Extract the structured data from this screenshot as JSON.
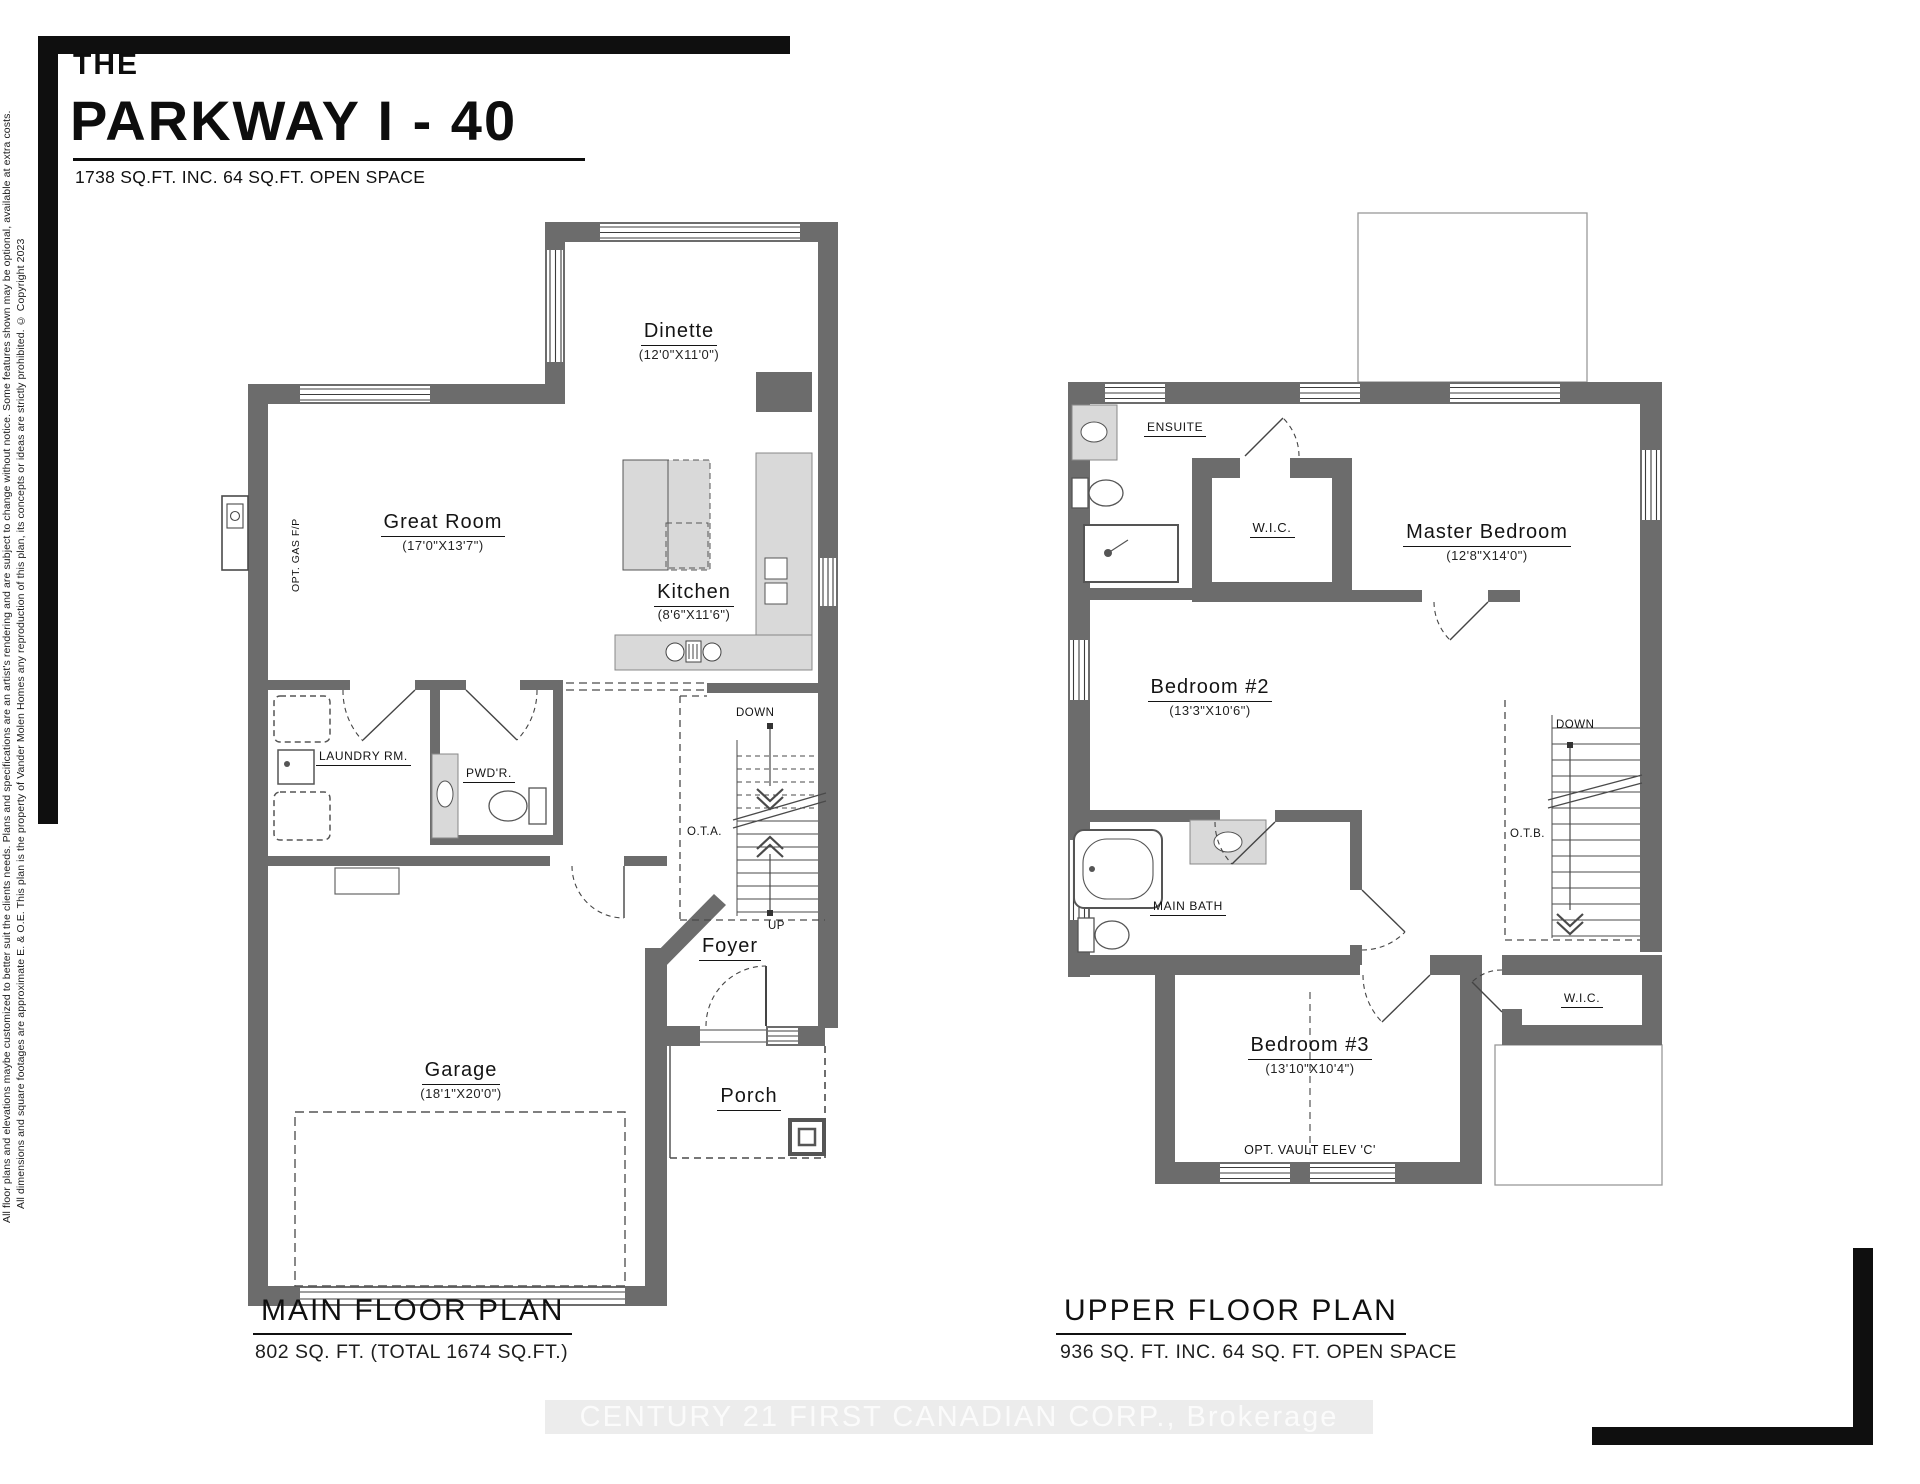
{
  "header": {
    "the": "THE",
    "title": "PARKWAY I - 40",
    "subtitle": "1738 SQ.FT. INC. 64 SQ.FT. OPEN SPACE"
  },
  "side_notes": {
    "line1": "All floor plans and elevations maybe customized to better suit the clients needs. Plans and specifications are an artist's rendering and are subject to change without notice. Some features shown may be optional, available at extra costs.",
    "line2": "All dimensions and square footages are approximate E. & O.E. This plan is the property of Vander Molen Homes any reproduction of this plan, its concepts or ideas are strictly prohibited. © Copyright 2023"
  },
  "watermark": "CENTURY 21 FIRST CANADIAN CORP., Brokerage",
  "main": {
    "caption": "MAIN FLOOR PLAN",
    "caption_sub": "802 SQ. FT. (TOTAL 1674 SQ.FT.)",
    "dinette": "Dinette",
    "dinette_dims": "(12'0\"X11'0\")",
    "great_room": "Great Room",
    "great_room_dims": "(17'0\"X13'7\")",
    "kitchen": "Kitchen",
    "kitchen_dims": "(8'6\"X11'6\")",
    "laundry": "LAUNDRY RM.",
    "powder": "PWD'R.",
    "foyer": "Foyer",
    "garage": "Garage",
    "garage_dims": "(18'1\"X20'0\")",
    "porch": "Porch",
    "down": "DOWN",
    "up": "UP",
    "ota": "O.T.A.",
    "gas_fp": "OPT. GAS F/P"
  },
  "upper": {
    "caption": "UPPER FLOOR PLAN",
    "caption_sub": "936 SQ. FT. INC. 64 SQ. FT. OPEN SPACE",
    "ensuite": "ENSUITE",
    "wic": "W.I.C.",
    "master": "Master Bedroom",
    "master_dims": "(12'8\"X14'0\")",
    "bedroom2": "Bedroom #2",
    "bedroom2_dims": "(13'3\"X10'6\")",
    "main_bath": "MAIN BATH",
    "wic2": "W.I.C.",
    "bedroom3": "Bedroom #3",
    "bedroom3_dims": "(13'10\"X10'4\")",
    "down": "DOWN",
    "otb": "O.T.B.",
    "vault": "OPT. VAULT ELEV 'C'"
  },
  "colors": {
    "wall": "#6c6c6c",
    "fixture_fill": "#d9d9d9",
    "line": "#4a4a4a",
    "watermark_bg": "#ececec",
    "watermark_text": "#fbfbfb"
  }
}
